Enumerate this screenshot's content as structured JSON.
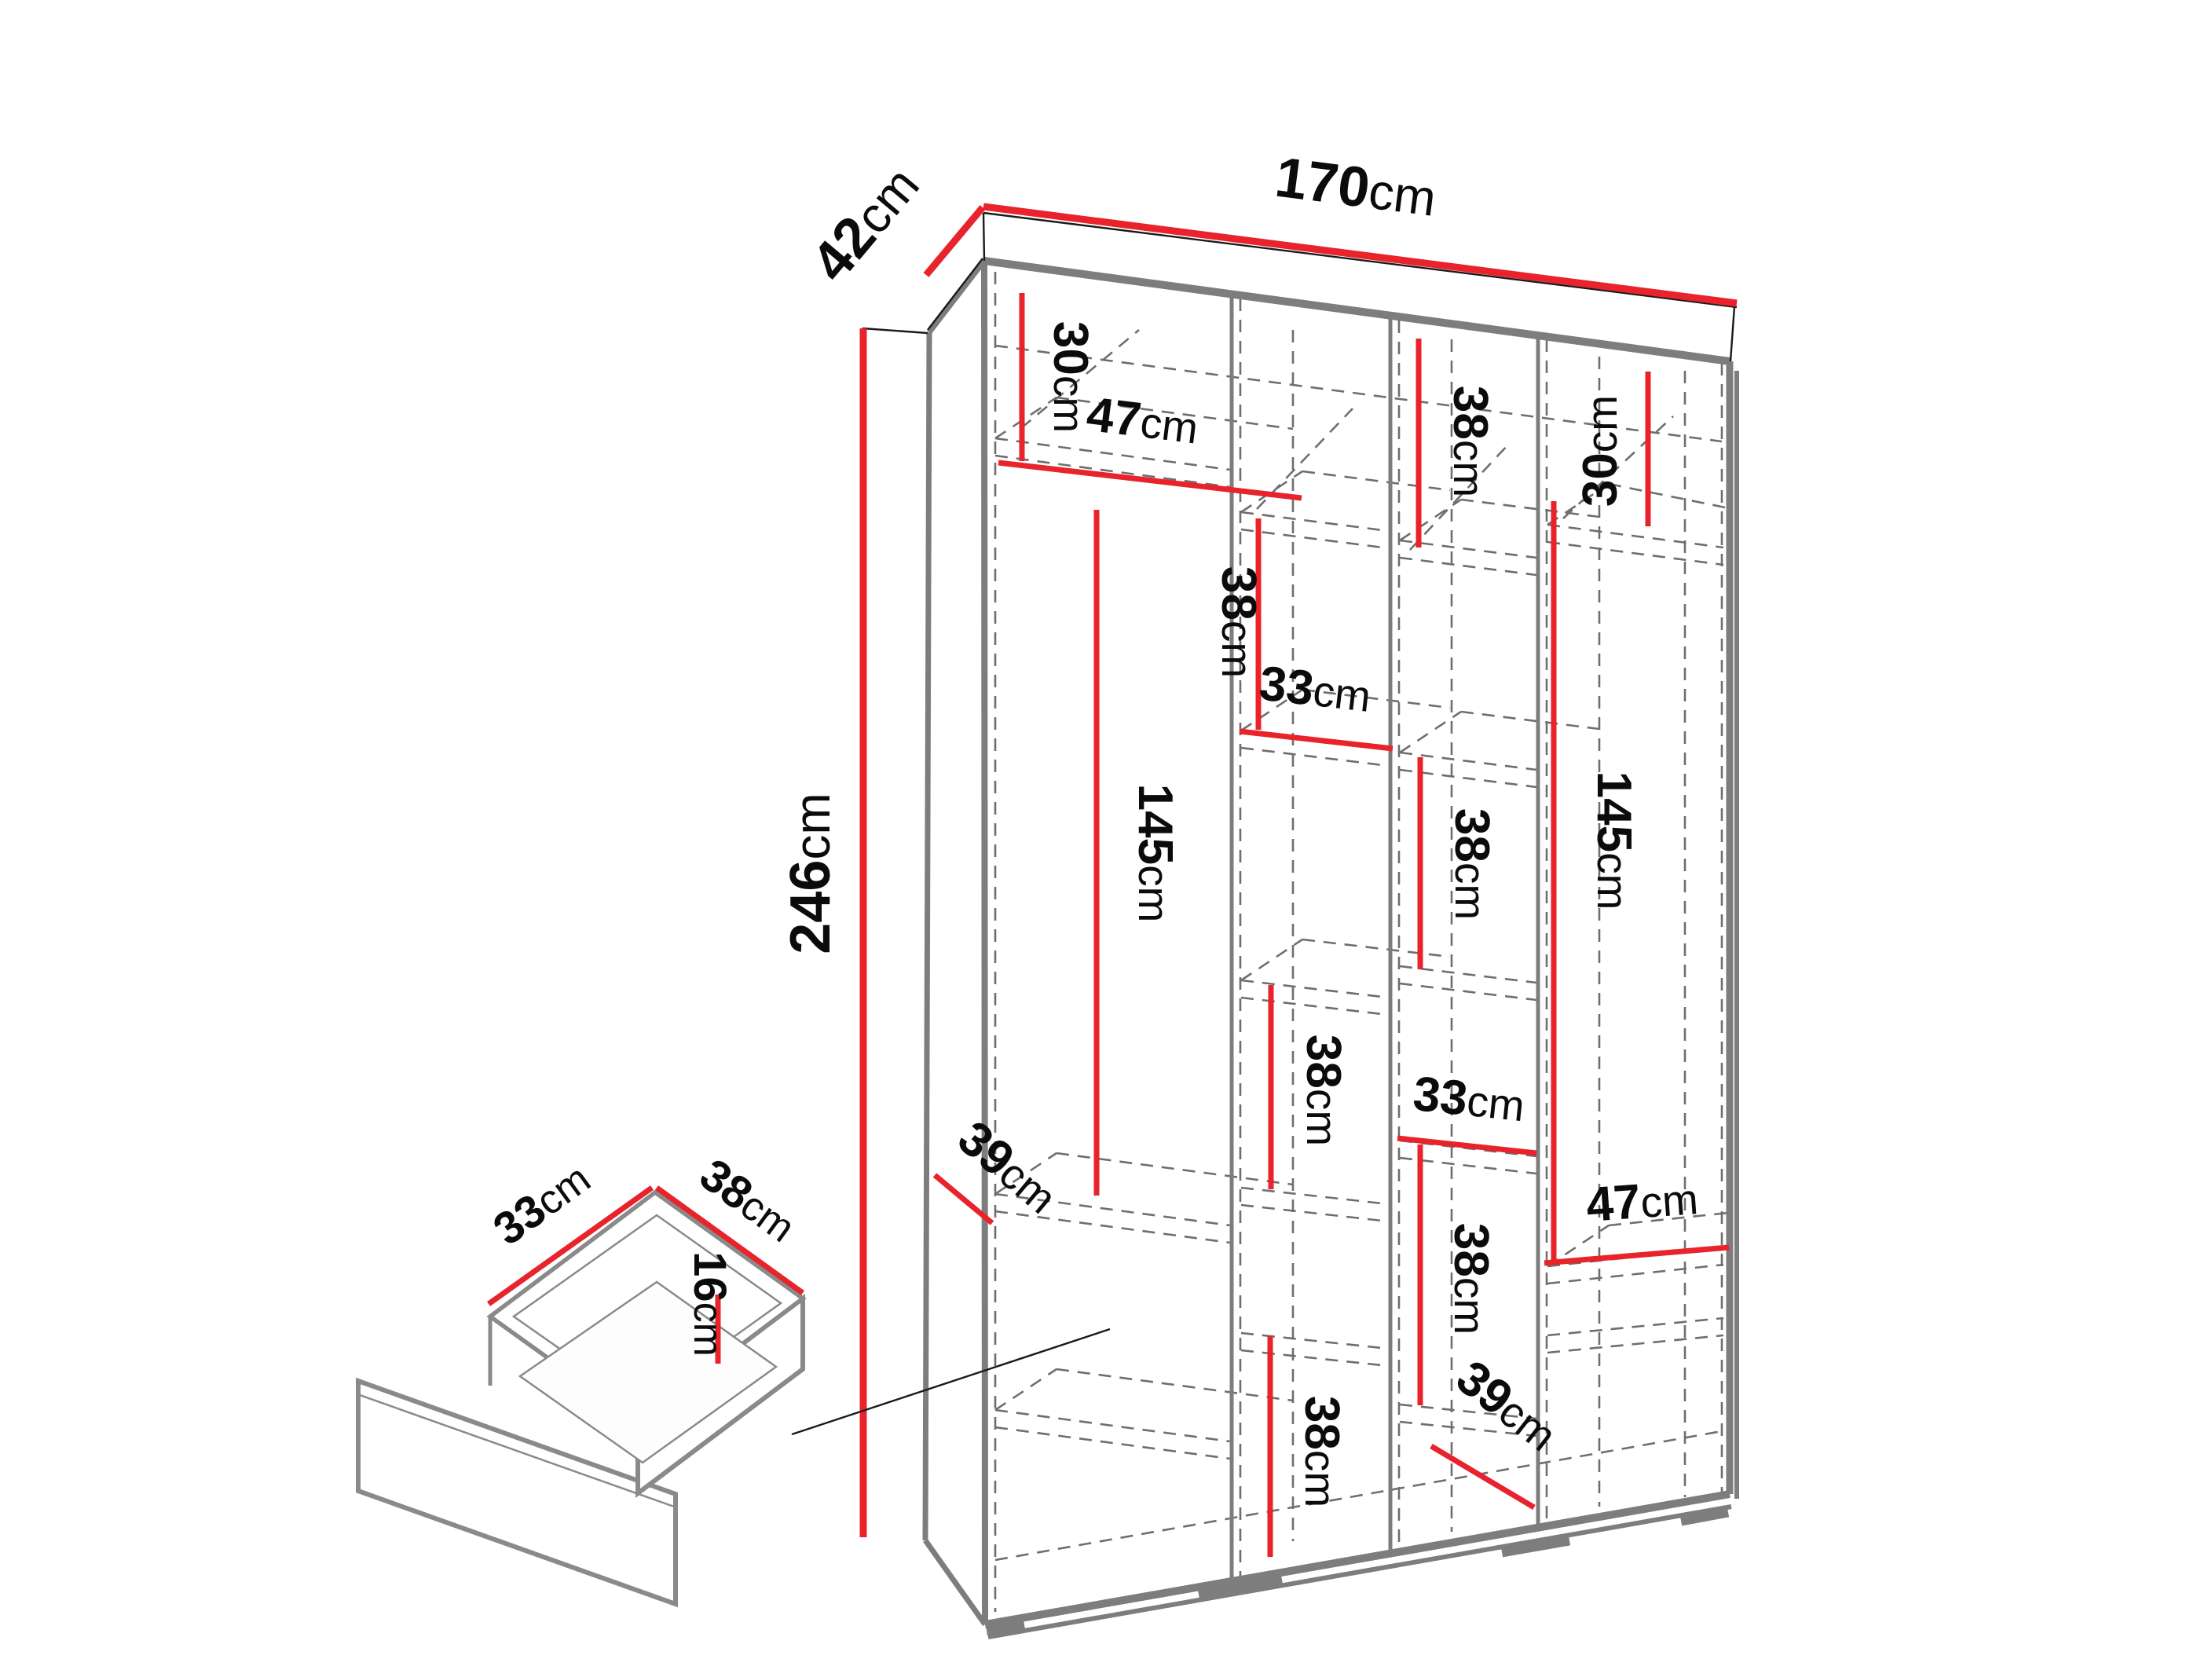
{
  "diagram": {
    "kind": "furniture dimension diagram",
    "subject": "wardrobe with internal shelving and drawer detail",
    "accent_color": "#e8232b",
    "line_color": "#7d7d7d",
    "dash_color": "#6e6e6e",
    "background": "#ffffff"
  },
  "wardrobe": {
    "overall_width": "170cm",
    "overall_depth": "42cm",
    "overall_height": "246cm",
    "labels": {
      "width_top": {
        "value": "170",
        "unit": "cm"
      },
      "depth_top": {
        "value": "42",
        "unit": "cm"
      },
      "height_left": {
        "value": "246",
        "unit": "cm"
      },
      "c1_top": {
        "value": "30",
        "unit": "cm"
      },
      "c1_shelf": {
        "value": "47",
        "unit": "cm"
      },
      "c1_hang": {
        "value": "145",
        "unit": "cm"
      },
      "c1_depth": {
        "value": "39",
        "unit": "cm"
      },
      "c2_upper": {
        "value": "38",
        "unit": "cm"
      },
      "c2_shelf": {
        "value": "33",
        "unit": "cm"
      },
      "c2_mid": {
        "value": "38",
        "unit": "cm"
      },
      "c2_bottom": {
        "value": "38",
        "unit": "cm"
      },
      "c3_top": {
        "value": "38",
        "unit": "cm"
      },
      "c3_mid": {
        "value": "38",
        "unit": "cm"
      },
      "c3_shelf": {
        "value": "33",
        "unit": "cm"
      },
      "c3_lower": {
        "value": "38",
        "unit": "cm"
      },
      "c3_depth": {
        "value": "39",
        "unit": "cm"
      },
      "c4_top": {
        "value": "30",
        "unit": "cm"
      },
      "c4_hang": {
        "value": "145",
        "unit": "cm"
      },
      "c4_shelf": {
        "value": "47",
        "unit": "cm"
      }
    }
  },
  "drawer": {
    "labels": {
      "width": {
        "value": "33",
        "unit": "cm"
      },
      "depth": {
        "value": "38",
        "unit": "cm"
      },
      "height": {
        "value": "16",
        "unit": "cm"
      }
    }
  }
}
